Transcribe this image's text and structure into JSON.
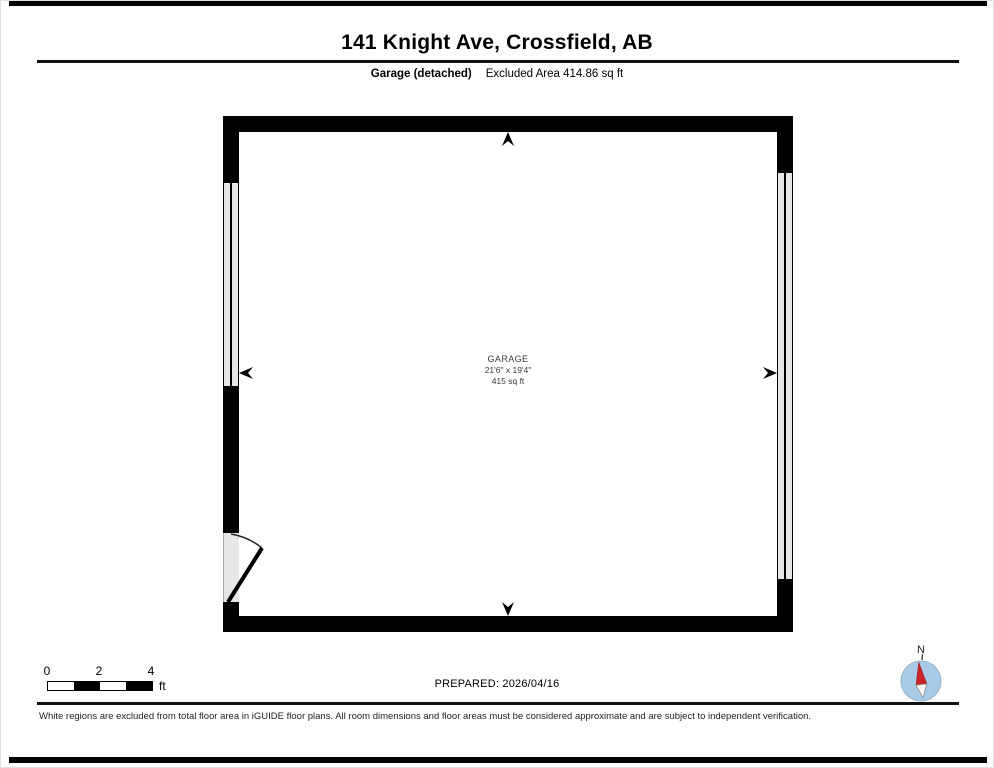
{
  "page": {
    "title": "141 Knight Ave, Crossfield, AB",
    "subtitle_label": "Garage (detached)",
    "subtitle_value": "Excluded Area 414.86 sq ft",
    "prepared": "PREPARED: 2026/04/16",
    "disclaimer": "White regions are excluded from total floor area in iGUIDE floor plans. All room dimensions and floor areas must be considered approximate and are subject to independent verification."
  },
  "room": {
    "name": "GARAGE",
    "dimensions": "21'6\" x 19'4\"",
    "area": "415 sq ft"
  },
  "scale_bar": {
    "labels": [
      "0",
      "2",
      "4"
    ],
    "unit": "ft"
  },
  "compass": {
    "north_label": "N"
  },
  "colors": {
    "wall": "#000000",
    "window_fill": "#e7e7e7",
    "compass_circle": "#a8cbe8",
    "compass_needle_north": "#c9252b"
  }
}
